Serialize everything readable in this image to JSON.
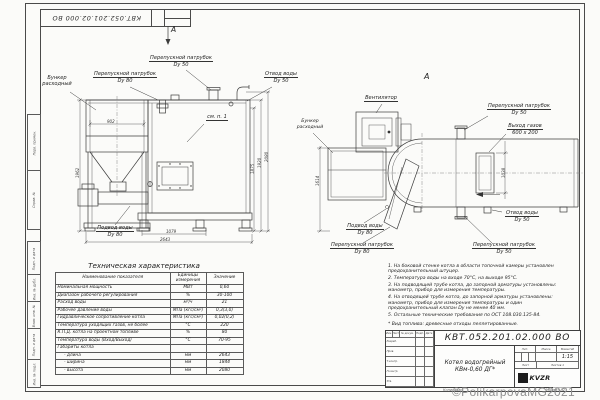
{
  "title_block": {
    "doc_number": "КВТ.052.201.02.000 ВО",
    "name_line1": "Котел водогрейный",
    "name_line2": "КВм-0,60 ДГ*",
    "header_cols": [
      "Изм.",
      "Лист",
      "№ докум.",
      "Подп.",
      "Дата"
    ],
    "staff": [
      "Разраб.",
      "Пров.",
      "Т.контр.",
      "Н.контр.",
      "Утв."
    ],
    "lit_label": "Лит.",
    "mass_label": "Масса",
    "scale_label": "Масштаб",
    "scale": "1:15",
    "sheet_label": "Лист",
    "sheets_label": "Листов 1",
    "logo": "KVZR",
    "copied": "Копировал",
    "format": "Формат А2"
  },
  "frame": {
    "margin_labels": [
      "Перв. примен.",
      "Справ. №",
      "Подп. и дата",
      "Инв. № дубл.",
      "Взам. инв. №",
      "Подп. и дата",
      "Инв. № подл."
    ]
  },
  "views": {
    "left": {
      "marker": "А",
      "callouts": {
        "bunker": [
          "Бункер",
          "расходный"
        ],
        "bypass80": [
          "Перепускной патрубок",
          "Dy 80"
        ],
        "bypass50": [
          "Перепускной патрубок",
          "Dy 50"
        ],
        "outlet50": [
          "Отвод воды",
          "Dy 50"
        ],
        "inlet80": [
          "Подвод воды",
          "Dy 80"
        ],
        "see_note": "см. п. 1"
      },
      "dims": {
        "bunker_width": "902",
        "bunker_height": "1962",
        "h1": "1875",
        "h2": "1920",
        "h3": "2080",
        "base_len": "1079",
        "total_len": "2643"
      }
    },
    "right": {
      "marker": "А",
      "callouts": {
        "fan": "Вентилятор",
        "bypass50_top": [
          "Перепускной патрубок",
          "Dy 50"
        ],
        "gas_exit": [
          "Выход газов",
          "600 x 200"
        ],
        "bunker": [
          "Бункер",
          "расходный"
        ],
        "inlet80": [
          "Подвод воды",
          "Dy 80"
        ],
        "bypass80": [
          "Перепускной патрубок",
          "Dy 80"
        ],
        "bypass50_bottom": [
          "Перепускной патрубок",
          "Dy 50"
        ],
        "outlet50": [
          "Отвод воды",
          "Dy 50"
        ]
      },
      "dims": {
        "bunker_height": "1614",
        "gas_height": "1038"
      }
    }
  },
  "spec_table": {
    "title": "Техническая характеристика",
    "headers": [
      "Наименование показателя",
      "Единицы измерения",
      "Значение"
    ],
    "rows": [
      [
        "Номинальная мощность",
        "МВт",
        "0,60"
      ],
      [
        "Диапазон рабочего регулирования",
        "%",
        "30-100"
      ],
      [
        "Расход воды",
        "м³/ч",
        "21"
      ],
      [
        "Рабочее давление воды",
        "МПа (кгс/см²)",
        "0,3(3,0)"
      ],
      [
        "Гидравлическое сопротивление котла",
        "МПа (кгс/см²)",
        "0,02(0,2)"
      ],
      [
        "Температура уходящих газов, не более",
        "°С",
        "220"
      ],
      [
        "К.П.Д. котла на проектном топливе",
        "%",
        "80"
      ],
      [
        "Температура воды (Вход/Выход)",
        "°С",
        "70-95"
      ],
      [
        "Габариты котла",
        "",
        ""
      ],
      [
        "- длина",
        "мм",
        "2643"
      ],
      [
        "- ширина",
        "мм",
        "1844"
      ],
      [
        "- высота",
        "мм",
        "2080"
      ]
    ]
  },
  "notes": [
    "1. На боковой стенке котла в области топочной камеры установлен предохранительный штуцер.",
    "2. Температура воды на входе 70°С, на выходе 95°С.",
    "3. На подводящей трубе котла, до запорной арматуры установлены: манометр, прибор для измерения температуры.",
    "4. На отводящей трубе котла, до запорной арматуры установлены: манометр, прибор для измерения температуры и один предохранительный клапан Dy не менее 40 мм.",
    "5. Остальные технические требования по ОСТ 108.030.135-84.",
    "* Вид топлива: древесные отходы пеллетированные."
  ],
  "watermark": "©PolikarpovaMG2021"
}
